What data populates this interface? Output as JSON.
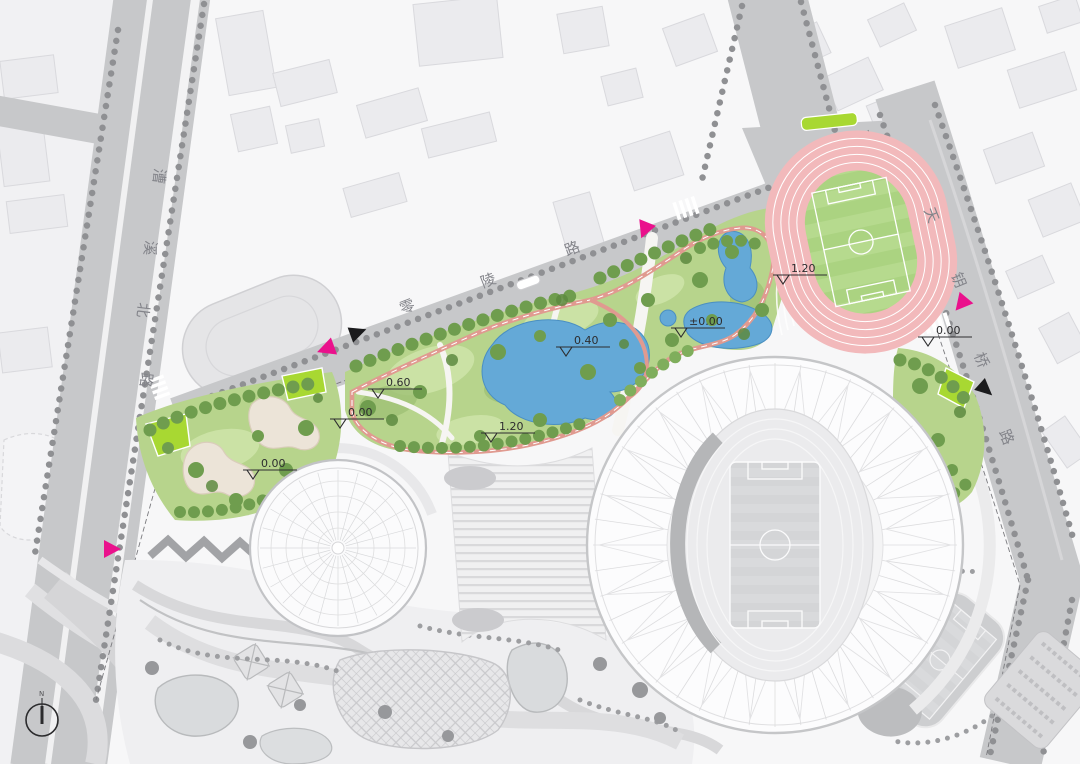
{
  "map": {
    "roads": {
      "west": {
        "name": "漕溪北路",
        "chars": [
          "漕",
          "溪",
          "北",
          "路"
        ]
      },
      "north": {
        "name": "零陵路",
        "chars": [
          "零",
          "陵",
          "路"
        ]
      },
      "east": {
        "name": "天钥桥路",
        "chars": [
          "天",
          "钥",
          "桥",
          "路"
        ]
      }
    },
    "elevations": [
      {
        "value": "0.00"
      },
      {
        "value": "0.00"
      },
      {
        "value": "0.60"
      },
      {
        "value": "1.20"
      },
      {
        "value": "0.40"
      },
      {
        "value": "±0.00"
      },
      {
        "value": "1.20"
      },
      {
        "value": "0.00"
      }
    ],
    "compass": {
      "label": "N"
    },
    "colors": {
      "entrance": "#ea118c",
      "marker_black": "#1b1b1d",
      "park": "#b7d48c",
      "water": "#64a9d7",
      "track": "#f2b9bb",
      "field": "#abd381",
      "road": "#c7c8ca",
      "accent_lime": "#a8d832"
    }
  }
}
